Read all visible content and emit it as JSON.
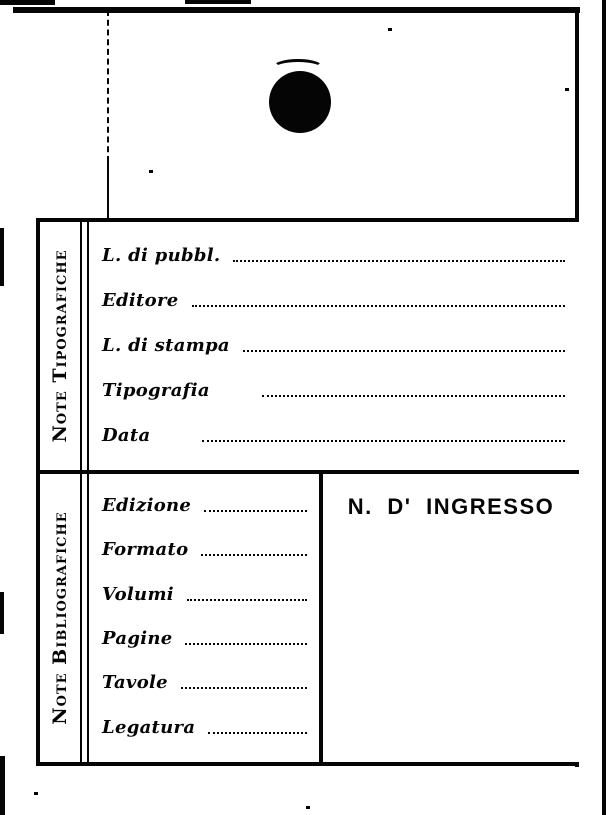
{
  "card": {
    "typographic_section": {
      "title": "Note Tipografiche",
      "fields": [
        "L. di pubbl.",
        "Editore",
        "L. di stampa",
        "Tipografia",
        "Data"
      ]
    },
    "bibliographic_section": {
      "title": "Note Bibliografiche",
      "fields": [
        "Edizione",
        "Formato",
        "Volumi",
        "Pagine",
        "Tavole",
        "Legatura"
      ],
      "ingresso_label": "N. D' INGRESSO"
    }
  }
}
